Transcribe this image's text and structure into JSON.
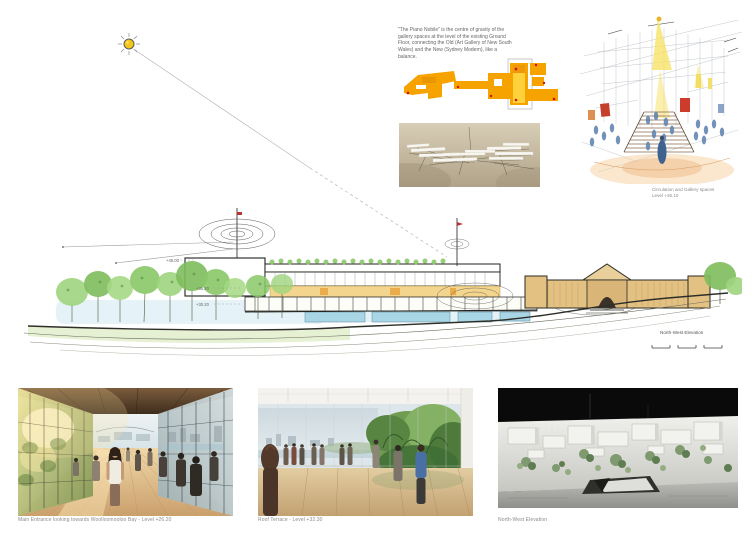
{
  "palette": {
    "plan_orange": "#F6A300",
    "plan_yellow": "#FFD23B",
    "accent_red": "#CC1111",
    "tree_green": "#8CC868",
    "sandstone_tan": "#E3C183",
    "water_blue": "#A9D6E4",
    "sun_yellow": "#F5C518",
    "photo_black": "#0A0A0A"
  },
  "note": {
    "text": "\"The Piano Nobile\" is the centre of gravity of the gallery spaces at the level of the existing Ground Floor, connecting the Old (Art Gallery of New South Wales) and the New (Sydney Modern), like a balance."
  },
  "sketch": {
    "caption_line1": "Circulation and Gallery spaces",
    "caption_line2": "Level +26.10"
  },
  "elevation": {
    "caption": "North-West Elevation",
    "levels": [
      "+46.00",
      "+35.20",
      "+30.20"
    ]
  },
  "renders": [
    {
      "caption": "Main Entrance looking towards Woolloomooloo Bay - Level +26.20"
    },
    {
      "caption": "Roof Terrace - Level +32.30"
    },
    {
      "caption": "North-West Elevation"
    }
  ]
}
